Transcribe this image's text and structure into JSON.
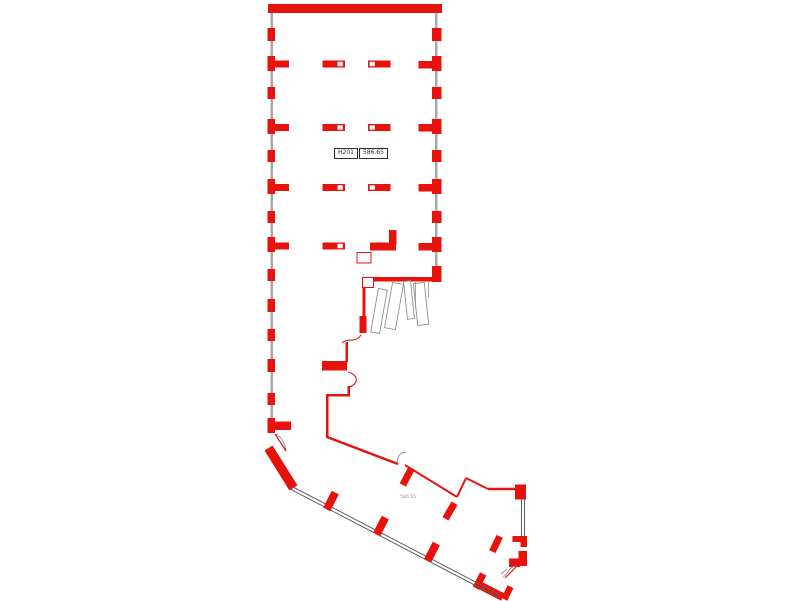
{
  "canvas": {
    "w": 800,
    "h": 601,
    "bg": "#ffffff"
  },
  "palette": {
    "wall_red": "#e8120d",
    "glass_gray": "#a9a9a9",
    "line_dark": "#5f5f5f",
    "door_gray": "#8f8f8f",
    "label_text": "#2f2f2f",
    "note_text": "#949494"
  },
  "room_label": {
    "room": "H201",
    "area": "586.65"
  },
  "area_note": "586.65",
  "shapes": [
    {
      "t": "rect",
      "n": "wall-top",
      "x": 268,
      "y": 4,
      "w": 174,
      "h": 9
    },
    {
      "t": "rect",
      "n": "glass-strip-left",
      "x": 270.5,
      "y": 13,
      "w": 2.5,
      "h": 420,
      "f": "glass_gray"
    },
    {
      "t": "rect",
      "n": "glass-strip-right",
      "x": 435,
      "y": 13,
      "w": 2.5,
      "h": 253,
      "f": "glass_gray"
    },
    {
      "t": "rect",
      "n": "pier-left",
      "x": 267.5,
      "y": 28,
      "w": 7.5,
      "h": 13
    },
    {
      "t": "rect",
      "n": "pier-left",
      "x": 267.5,
      "y": 56,
      "w": 7.5,
      "h": 15
    },
    {
      "t": "rect",
      "n": "pier-left",
      "x": 267.5,
      "y": 87,
      "w": 7.5,
      "h": 12
    },
    {
      "t": "rect",
      "n": "pier-left",
      "x": 267.5,
      "y": 119,
      "w": 7.5,
      "h": 15
    },
    {
      "t": "rect",
      "n": "pier-left",
      "x": 267.5,
      "y": 150,
      "w": 7.5,
      "h": 12
    },
    {
      "t": "rect",
      "n": "pier-left",
      "x": 267.5,
      "y": 179,
      "w": 7.5,
      "h": 15
    },
    {
      "t": "rect",
      "n": "pier-left",
      "x": 267.5,
      "y": 211,
      "w": 7.5,
      "h": 12
    },
    {
      "t": "rect",
      "n": "pier-left",
      "x": 267.5,
      "y": 237,
      "w": 7.5,
      "h": 15
    },
    {
      "t": "rect",
      "n": "pier-left",
      "x": 267.5,
      "y": 269,
      "w": 7.5,
      "h": 12
    },
    {
      "t": "rect",
      "n": "pier-left",
      "x": 267.5,
      "y": 299,
      "w": 7.5,
      "h": 13
    },
    {
      "t": "rect",
      "n": "pier-left",
      "x": 267.5,
      "y": 329,
      "w": 7.5,
      "h": 12
    },
    {
      "t": "rect",
      "n": "pier-left",
      "x": 267.5,
      "y": 359,
      "w": 7.5,
      "h": 13
    },
    {
      "t": "rect",
      "n": "pier-left",
      "x": 267.5,
      "y": 393,
      "w": 7.5,
      "h": 12
    },
    {
      "t": "rect",
      "n": "pier-left",
      "x": 267.5,
      "y": 418,
      "w": 7.5,
      "h": 15
    },
    {
      "t": "rect",
      "n": "pier-stub-left",
      "x": 275,
      "y": 60.5,
      "w": 14,
      "h": 7
    },
    {
      "t": "rect",
      "n": "pier-stub-left",
      "x": 275,
      "y": 124,
      "w": 14,
      "h": 7
    },
    {
      "t": "rect",
      "n": "pier-stub-left",
      "x": 275,
      "y": 184,
      "w": 14,
      "h": 7
    },
    {
      "t": "rect",
      "n": "pier-stub-left",
      "x": 275,
      "y": 242.5,
      "w": 14,
      "h": 7
    },
    {
      "t": "rect",
      "n": "pier-stub-left",
      "x": 275,
      "y": 421.5,
      "w": 16,
      "h": 8.5
    },
    {
      "t": "rect",
      "n": "pier-right",
      "x": 432,
      "y": 28,
      "w": 9.5,
      "h": 13
    },
    {
      "t": "rect",
      "n": "pier-right",
      "x": 432,
      "y": 56,
      "w": 9.5,
      "h": 15
    },
    {
      "t": "rect",
      "n": "pier-right",
      "x": 432,
      "y": 87,
      "w": 9.5,
      "h": 12
    },
    {
      "t": "rect",
      "n": "pier-right",
      "x": 432,
      "y": 119,
      "w": 9.5,
      "h": 15
    },
    {
      "t": "rect",
      "n": "pier-right",
      "x": 432,
      "y": 150,
      "w": 9.5,
      "h": 12
    },
    {
      "t": "rect",
      "n": "pier-right",
      "x": 432,
      "y": 179,
      "w": 9.5,
      "h": 15
    },
    {
      "t": "rect",
      "n": "pier-right",
      "x": 432,
      "y": 211,
      "w": 9.5,
      "h": 12
    },
    {
      "t": "rect",
      "n": "pier-right",
      "x": 432,
      "y": 237,
      "w": 9.5,
      "h": 15
    },
    {
      "t": "rect",
      "n": "pier-right",
      "x": 432,
      "y": 266,
      "w": 9.5,
      "h": 16
    },
    {
      "t": "rect",
      "n": "pier-stub-right",
      "x": 418.5,
      "y": 61,
      "w": 14,
      "h": 7.5
    },
    {
      "t": "rect",
      "n": "pier-stub-right",
      "x": 418.5,
      "y": 124,
      "w": 14,
      "h": 7.5
    },
    {
      "t": "rect",
      "n": "pier-stub-right",
      "x": 418.5,
      "y": 184,
      "w": 14,
      "h": 7.5
    },
    {
      "t": "rect",
      "n": "pier-stub-right",
      "x": 418.5,
      "y": 243,
      "w": 14,
      "h": 7.5
    },
    {
      "t": "rect",
      "n": "column",
      "x": 322.5,
      "y": 60.5,
      "w": 22.5,
      "h": 7
    },
    {
      "t": "rect",
      "n": "column-notch",
      "x": 337.5,
      "y": 61.8,
      "w": 5.3,
      "h": 4.4,
      "f": "#ffffff"
    },
    {
      "t": "rect",
      "n": "column",
      "x": 368,
      "y": 60.5,
      "w": 22.5,
      "h": 7
    },
    {
      "t": "rect",
      "n": "column-notch",
      "x": 369.6,
      "y": 61.8,
      "w": 5.3,
      "h": 4.4,
      "f": "#ffffff"
    },
    {
      "t": "rect",
      "n": "column",
      "x": 322.5,
      "y": 124,
      "w": 22.5,
      "h": 7
    },
    {
      "t": "rect",
      "n": "column-notch",
      "x": 337.5,
      "y": 125.3,
      "w": 5.3,
      "h": 4.4,
      "f": "#ffffff"
    },
    {
      "t": "rect",
      "n": "column",
      "x": 368,
      "y": 124,
      "w": 22.5,
      "h": 7
    },
    {
      "t": "rect",
      "n": "column-notch",
      "x": 369.6,
      "y": 125.3,
      "w": 5.3,
      "h": 4.4,
      "f": "#ffffff"
    },
    {
      "t": "rect",
      "n": "column",
      "x": 322.5,
      "y": 184,
      "w": 22.5,
      "h": 7
    },
    {
      "t": "rect",
      "n": "column-notch",
      "x": 337.5,
      "y": 185.3,
      "w": 5.3,
      "h": 4.4,
      "f": "#ffffff"
    },
    {
      "t": "rect",
      "n": "column",
      "x": 368,
      "y": 184,
      "w": 22.5,
      "h": 7
    },
    {
      "t": "rect",
      "n": "column-notch",
      "x": 369.6,
      "y": 185.3,
      "w": 5.3,
      "h": 4.4,
      "f": "#ffffff"
    },
    {
      "t": "rect",
      "n": "column",
      "x": 322.5,
      "y": 242.5,
      "w": 22.5,
      "h": 7
    },
    {
      "t": "rect",
      "n": "column-notch",
      "x": 337.5,
      "y": 243.8,
      "w": 5.3,
      "h": 4.4,
      "f": "#ffffff"
    },
    {
      "t": "rect",
      "n": "column",
      "x": 370,
      "y": 242.5,
      "w": 26,
      "h": 8
    },
    {
      "t": "rect",
      "n": "wall-nub",
      "x": 389,
      "y": 230,
      "w": 7.5,
      "h": 14
    },
    {
      "t": "rect",
      "n": "column-outline",
      "x": 357,
      "y": 252.5,
      "w": 14,
      "h": 10.5,
      "o": true,
      "s": "wall_red",
      "sw": 1
    },
    {
      "t": "rect",
      "n": "wall-south",
      "x": 373,
      "y": 277,
      "w": 68.5,
      "h": 4.5
    },
    {
      "t": "rect",
      "n": "wall-step-notch",
      "x": 362.5,
      "y": 277.5,
      "w": 11,
      "h": 10,
      "o": true,
      "s": "wall_red",
      "sw": 1
    },
    {
      "t": "rect",
      "n": "wall-inner-left",
      "x": 362.5,
      "y": 287,
      "w": 3,
      "h": 31
    },
    {
      "t": "rect",
      "n": "wall-inner-left-thick",
      "x": 359.5,
      "y": 316,
      "w": 7,
      "h": 17
    },
    {
      "t": "path",
      "n": "door-arc",
      "d": "M361,335 C355,344 347,337 342,343",
      "s": "wall_red",
      "sw": 1.1
    },
    {
      "t": "rect",
      "n": "wall-inner-left",
      "x": 345.5,
      "y": 342,
      "w": 2.5,
      "h": 20
    },
    {
      "t": "rect",
      "n": "wall-stub",
      "x": 322,
      "y": 361,
      "w": 25,
      "h": 9.5
    },
    {
      "t": "path",
      "n": "door-arc",
      "d": "M348,372 C359,375 359,384 349,387",
      "s": "wall_red",
      "sw": 1.1
    },
    {
      "t": "rect",
      "n": "wall-inner-left",
      "x": 347.5,
      "y": 386,
      "w": 2.5,
      "h": 10
    },
    {
      "t": "rect",
      "n": "wall-step",
      "x": 326,
      "y": 394,
      "w": 24,
      "h": 2.5
    },
    {
      "t": "rect",
      "n": "wall-inner-left",
      "x": 326,
      "y": 394,
      "w": 2.5,
      "h": 44
    },
    {
      "t": "line",
      "n": "wall-diagonal",
      "x1": 327,
      "y1": 437,
      "x2": 398,
      "y2": 464,
      "s": "wall_red",
      "sw": 2.5
    },
    {
      "t": "path",
      "n": "door-arc-gray",
      "d": "M397,462 C398,455 402,451 406,453",
      "s": "door_gray",
      "sw": 1
    },
    {
      "t": "rect",
      "n": "pier-diagonal",
      "cx": 407,
      "cy": 477,
      "w": 7,
      "h": 18,
      "rot": 28
    },
    {
      "t": "line",
      "n": "wall-diagonal",
      "x1": 405,
      "y1": 465,
      "x2": 457,
      "y2": 497,
      "s": "wall_red",
      "sw": 2
    },
    {
      "t": "rect",
      "n": "pier-diagonal",
      "cx": 450,
      "cy": 511,
      "w": 7,
      "h": 18,
      "rot": 30
    },
    {
      "t": "line",
      "n": "wall-zigzag",
      "x1": 457,
      "y1": 497,
      "x2": 466,
      "y2": 478,
      "s": "wall_red",
      "sw": 2
    },
    {
      "t": "line",
      "n": "wall-zigzag",
      "x1": 466,
      "y1": 478,
      "x2": 488,
      "y2": 489,
      "s": "wall_red",
      "sw": 2
    },
    {
      "t": "line",
      "n": "wall-zigzag",
      "x1": 488,
      "y1": 489,
      "x2": 517,
      "y2": 489,
      "s": "wall_red",
      "sw": 2.5
    },
    {
      "t": "rect",
      "n": "wall-block",
      "x": 515,
      "y": 484.5,
      "w": 11,
      "h": 15
    },
    {
      "t": "line",
      "n": "glass-double-line",
      "x1": 521.5,
      "y1": 499,
      "x2": 521.5,
      "y2": 537,
      "s": "line_dark",
      "sw": 1
    },
    {
      "t": "line",
      "n": "glass-double-line",
      "x1": 524.5,
      "y1": 499,
      "x2": 524.5,
      "y2": 537,
      "s": "line_dark",
      "sw": 1
    },
    {
      "t": "rect",
      "n": "door-jamb",
      "x": 512.5,
      "y": 536,
      "w": 14,
      "h": 6
    },
    {
      "t": "rect",
      "n": "door-jamb",
      "x": 520.5,
      "y": 536,
      "w": 6.5,
      "h": 11
    },
    {
      "t": "rect",
      "n": "door-jamb",
      "x": 518.5,
      "y": 551,
      "w": 8.5,
      "h": 15
    },
    {
      "t": "rect",
      "n": "door-jamb",
      "x": 509,
      "y": 558.5,
      "w": 11,
      "h": 8.5
    },
    {
      "t": "path",
      "n": "door-arc-gray",
      "d": "M517,566 C509,566 509,573 503,577 M507,569 L501,574",
      "s": "door_gray",
      "sw": 1
    },
    {
      "t": "line",
      "n": "door-leaf",
      "x1": 517,
      "y1": 566,
      "x2": 505,
      "y2": 578,
      "s": "wall_red",
      "sw": 1.2
    },
    {
      "t": "rect",
      "n": "pier-diagonal",
      "cx": 507.5,
      "cy": 593,
      "w": 6.5,
      "h": 14,
      "rot": 26
    },
    {
      "t": "rect",
      "n": "door-sill",
      "cx": 490,
      "cy": 590.5,
      "w": 29,
      "h": 8,
      "rot": 27
    },
    {
      "t": "rect",
      "n": "door-jamb",
      "cx": 479.5,
      "cy": 581,
      "w": 7,
      "h": 16,
      "rot": 27
    },
    {
      "t": "path",
      "n": "door-arc-gray",
      "d": "M276,434 C282,438 285,444 286,451",
      "s": "door_gray",
      "sw": 1
    },
    {
      "t": "line",
      "n": "door-leaf",
      "x1": 275,
      "y1": 434,
      "x2": 286,
      "y2": 451,
      "s": "wall_red",
      "sw": 1.2
    },
    {
      "t": "rect",
      "n": "wall-corner-diagonal",
      "cx": 281,
      "cy": 468,
      "w": 9.5,
      "h": 47,
      "rot": -32
    },
    {
      "t": "line",
      "n": "glass-double-line",
      "x1": 292,
      "y1": 486.5,
      "x2": 500,
      "y2": 594.7,
      "s": "line_dark",
      "sw": 1
    },
    {
      "t": "line",
      "n": "glass-double-line",
      "x1": 290.6,
      "y1": 489.3,
      "x2": 498.6,
      "y2": 597.5,
      "s": "line_dark",
      "sw": 1
    },
    {
      "t": "rect",
      "n": "pier-window",
      "cx": 331,
      "cy": 501,
      "w": 8,
      "h": 19,
      "rot": 27
    },
    {
      "t": "rect",
      "n": "pier-window",
      "cx": 381,
      "cy": 526,
      "w": 8,
      "h": 19,
      "rot": 27
    },
    {
      "t": "rect",
      "n": "pier-window",
      "cx": 432,
      "cy": 552,
      "w": 8,
      "h": 19,
      "rot": 27
    },
    {
      "t": "rect",
      "n": "pier-free",
      "cx": 496,
      "cy": 544,
      "w": 7,
      "h": 17,
      "rot": 26
    },
    {
      "t": "rect",
      "n": "door-leaf-outline",
      "cx": 379,
      "cy": 311,
      "w": 9,
      "h": 44,
      "rot": 10,
      "o": true,
      "s": "door_gray",
      "sw": 0.9
    },
    {
      "t": "rect",
      "n": "door-leaf-outline",
      "cx": 394,
      "cy": 306,
      "w": 11,
      "h": 46,
      "rot": 10,
      "o": true,
      "s": "door_gray",
      "sw": 0.9
    },
    {
      "t": "rect",
      "n": "door-leaf-outline",
      "cx": 409,
      "cy": 300,
      "w": 7,
      "h": 38,
      "rot": -6,
      "o": true,
      "s": "door_gray",
      "sw": 0.9
    },
    {
      "t": "rect",
      "n": "door-leaf-outline",
      "cx": 421,
      "cy": 304,
      "w": 11,
      "h": 42,
      "rot": -6,
      "o": true,
      "s": "door_gray",
      "sw": 0.9
    },
    {
      "t": "line",
      "n": "door-track",
      "x1": 415.5,
      "y1": 282,
      "x2": 415.5,
      "y2": 308,
      "s": "door_gray",
      "sw": 0.8
    },
    {
      "t": "line",
      "n": "door-track",
      "x1": 428.5,
      "y1": 282,
      "x2": 428.5,
      "y2": 298,
      "s": "door_gray",
      "sw": 0.8
    }
  ]
}
